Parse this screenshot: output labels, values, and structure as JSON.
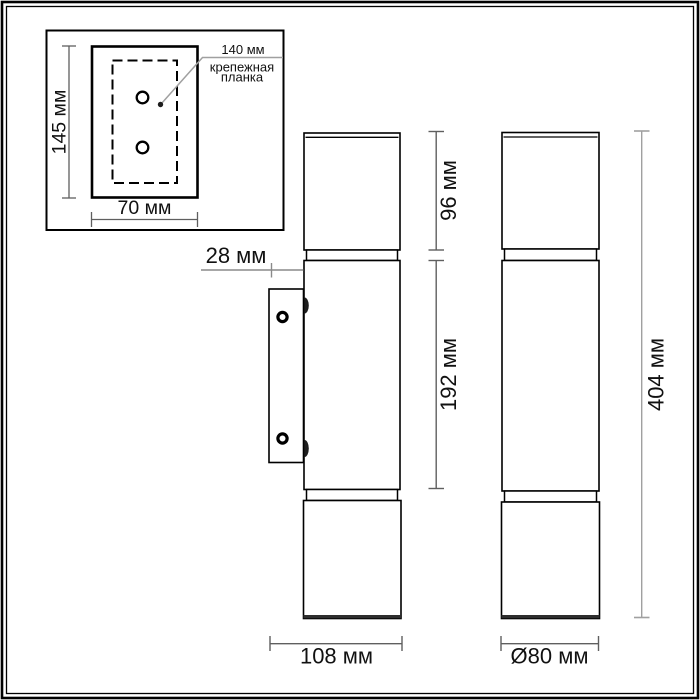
{
  "inset": {
    "plate_height": "145 мм",
    "plate_width": "70 мм",
    "callout_value": "140 мм",
    "callout_name_line1": "крепежная",
    "callout_name_line2": "планка"
  },
  "dimensions": {
    "wall_offset": "28 мм",
    "top_section_height": "96 мм",
    "middle_section_height": "192 мм",
    "overall_height": "404 мм",
    "overall_depth": "108 мм",
    "diameter": "Ø80 мм"
  },
  "colors": {
    "outline": "#000000",
    "dimension_line": "#5f5f5f",
    "light_dimension_line": "#a0a0a0",
    "text": "#111111",
    "background": "#ffffff"
  }
}
